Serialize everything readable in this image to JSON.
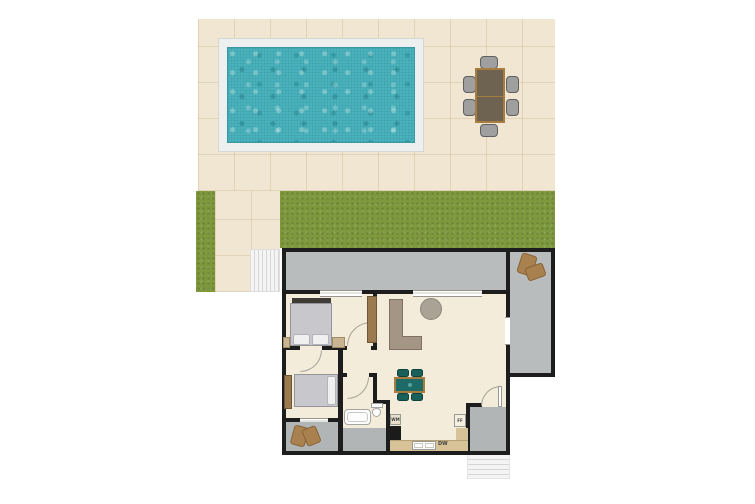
{
  "scene": {
    "type": "floor-plan",
    "view": "top-down",
    "sections": [
      "outdoor patio with swimming pool and dining set",
      "lawn strips",
      "single-storey house interior with wrap-around gray porch"
    ]
  },
  "labels": {
    "washing_machine": "WM",
    "dishwasher": "DW",
    "fridge_freezer": "FF"
  },
  "colors": {
    "background": "#ffffff",
    "patio": "#f1e6d2",
    "grass": "#7d983d",
    "pool-deck": "#eef0ef",
    "pool-water": "#49b3bd",
    "wall": "#1d1d1d",
    "floor": "#f3ecda",
    "porch": "#b9bcbc",
    "room-gray": "#b2b5b5",
    "counter": "#d8c398",
    "wood": "#9a7a4e",
    "table-wood": "#a87c3e",
    "teal": "#1e6a66",
    "sofa": "#a49584",
    "bed": "#c8c8cc",
    "steps": "#f4f4f4"
  },
  "outdoor": {
    "pool": {
      "shape": "rectangular",
      "surround": "white deck apron"
    },
    "dining_set": {
      "table": "rectangular wooden table",
      "chairs": 6
    },
    "lawn": [
      "horizontal strip between patio and house",
      "vertical strip at far left"
    ],
    "steps": [
      "walkway steps left of house",
      "steps below rear entry"
    ]
  },
  "house": {
    "porch": {
      "floor": "gray",
      "plants": 1
    },
    "rooms": [
      {
        "name": "bedroom-1",
        "furniture": [
          "double bed with pillows",
          "nightstand",
          "wardrobe"
        ]
      },
      {
        "name": "living-room",
        "furniture": [
          "L-shaped sofa",
          "round coffee table",
          "dining table with 4 teal chairs"
        ]
      },
      {
        "name": "bedroom-2",
        "furniture": [
          "double bed",
          "wardrobe"
        ]
      },
      {
        "name": "store-room",
        "furniture": [
          "plant"
        ],
        "floor": "gray"
      },
      {
        "name": "bathroom",
        "furniture": [
          "bathtub",
          "toilet"
        ],
        "shower_floor": "gray"
      },
      {
        "name": "kitchen",
        "furniture": [
          "washing machine",
          "oven",
          "counter with sink",
          "dishwasher",
          "fridge-freezer"
        ]
      },
      {
        "name": "entry-hall",
        "floor": "gray"
      }
    ]
  }
}
